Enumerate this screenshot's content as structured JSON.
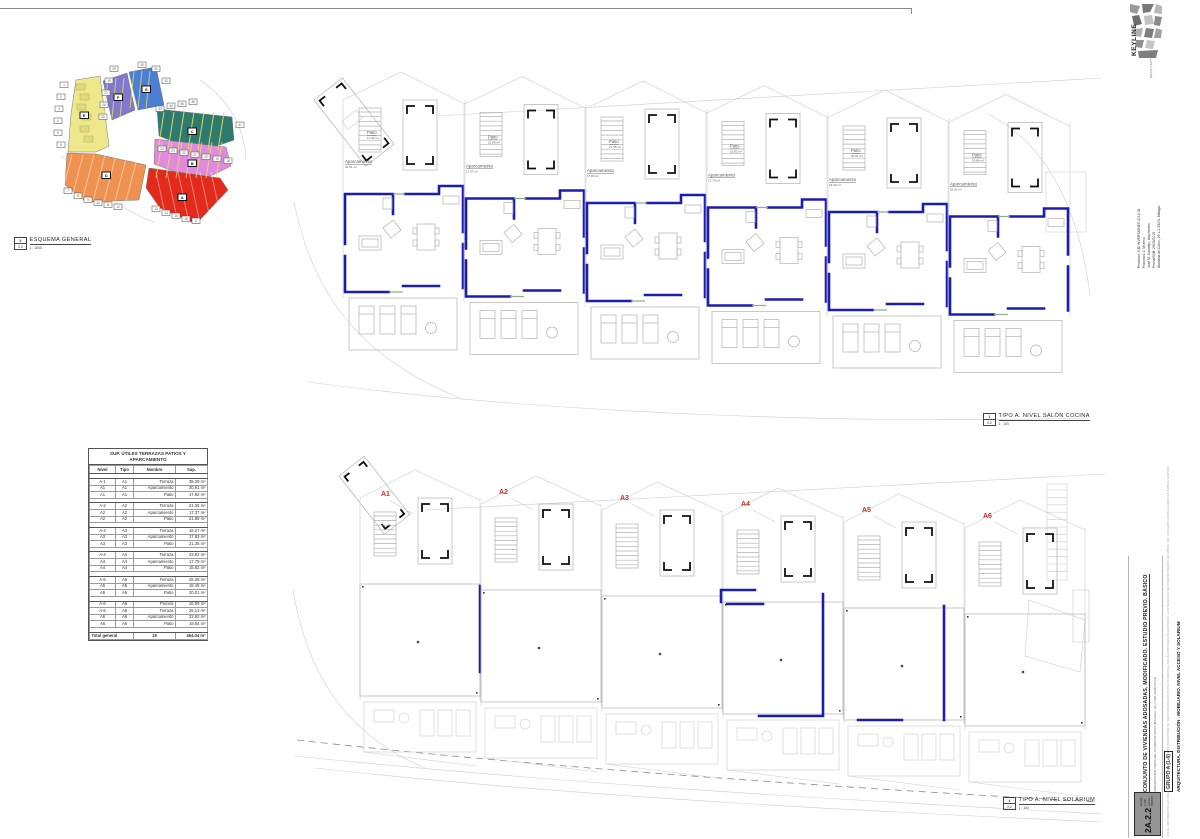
{
  "sheet": {
    "site_caption": {
      "ref_num": "3",
      "ref_sheet": "2.2",
      "title": "ESQUEMA GENERAL",
      "scale": "1 : 1000"
    },
    "plan_top_caption": {
      "ref_num": "1",
      "ref_sheet": "2.2",
      "title": "TIPO A. NIVEL SALÓN COCINA",
      "scale": "1 : 100"
    },
    "plan_bottom_caption": {
      "ref_num": "4",
      "ref_sheet": "2.2",
      "title": "TIPO A. NIVEL SOLARIUM",
      "scale": "1 : 100"
    }
  },
  "site_plan": {
    "zone_colors": {
      "yellow": "#efe88a",
      "purple": "#8078cc",
      "blue": "#4a7fd4",
      "teal": "#2f7a6e",
      "pink": "#e08ade",
      "orange": "#ef9251",
      "red": "#e32b1d"
    },
    "chips": [
      {
        "t": "1",
        "x": 10,
        "y": 22
      },
      {
        "t": "2",
        "x": 7,
        "y": 34
      },
      {
        "t": "3",
        "x": 5,
        "y": 46
      },
      {
        "t": "4",
        "x": 4,
        "y": 58
      },
      {
        "t": "5",
        "x": 4,
        "y": 70
      },
      {
        "t": "6",
        "x": 7,
        "y": 82
      },
      {
        "t": "29",
        "x": 60,
        "y": 6
      },
      {
        "t": "28",
        "x": 55,
        "y": 18
      },
      {
        "t": "27",
        "x": 52,
        "y": 30
      },
      {
        "t": "26",
        "x": 50,
        "y": 42
      },
      {
        "t": "25",
        "x": 49,
        "y": 54
      },
      {
        "t": "30",
        "x": 88,
        "y": 2
      },
      {
        "t": "31",
        "x": 102,
        "y": 6
      },
      {
        "t": "32",
        "x": 112,
        "y": 18
      },
      {
        "t": "33",
        "x": 106,
        "y": 46
      },
      {
        "t": "34",
        "x": 117,
        "y": 43
      },
      {
        "t": "35",
        "x": 128,
        "y": 41
      },
      {
        "t": "36",
        "x": 139,
        "y": 39
      },
      {
        "t": "37",
        "x": 186,
        "y": 62
      },
      {
        "t": "24",
        "x": 108,
        "y": 86
      },
      {
        "t": "23",
        "x": 119,
        "y": 88
      },
      {
        "t": "22",
        "x": 130,
        "y": 90
      },
      {
        "t": "21",
        "x": 141,
        "y": 92
      },
      {
        "t": "20",
        "x": 152,
        "y": 94
      },
      {
        "t": "19",
        "x": 163,
        "y": 96
      },
      {
        "t": "18",
        "x": 174,
        "y": 98
      },
      {
        "t": "7",
        "x": 14,
        "y": 128
      },
      {
        "t": "8",
        "x": 24,
        "y": 133
      },
      {
        "t": "9",
        "x": 34,
        "y": 137
      },
      {
        "t": "10",
        "x": 44,
        "y": 140
      },
      {
        "t": "11",
        "x": 54,
        "y": 142
      },
      {
        "t": "12",
        "x": 64,
        "y": 144
      },
      {
        "t": "13",
        "x": 102,
        "y": 146
      },
      {
        "t": "14",
        "x": 112,
        "y": 150
      },
      {
        "t": "15",
        "x": 122,
        "y": 153
      },
      {
        "t": "16",
        "x": 132,
        "y": 156
      },
      {
        "t": "17",
        "x": 142,
        "y": 158
      }
    ],
    "zone_boxes": [
      {
        "t": "E",
        "x": 30,
        "y": 52
      },
      {
        "t": "F",
        "x": 64,
        "y": 34
      },
      {
        "t": "G",
        "x": 92,
        "y": 26
      },
      {
        "t": "C",
        "x": 138,
        "y": 68
      },
      {
        "t": "B",
        "x": 138,
        "y": 100
      },
      {
        "t": "D",
        "x": 52,
        "y": 112
      },
      {
        "t": "A",
        "x": 128,
        "y": 134
      }
    ]
  },
  "area_table": {
    "title": "SUP. ÚTILES TERRAZAS PATIOS Y APARCAMIENTO",
    "columns": [
      "Nivel",
      "Tipo",
      "Nombre",
      "Sup."
    ],
    "groups": [
      {
        "rows": [
          [
            "A-1",
            "A1",
            "Terraza",
            "35.29 m²"
          ],
          [
            "A1",
            "A1",
            "Aparcamiento",
            "30.91 m²"
          ],
          [
            "A1",
            "A1",
            "Patio",
            "17.92 m²"
          ]
        ]
      },
      {
        "rows": [
          [
            "A-2",
            "A2",
            "Terraza",
            "21.35 m²"
          ],
          [
            "A2",
            "A2",
            "Aparcamiento",
            "17.37 m²"
          ],
          [
            "A2",
            "A2",
            "Patio",
            "21.88 m²"
          ]
        ]
      },
      {
        "rows": [
          [
            "A-3",
            "A3",
            "Terraza",
            "19.27 m²"
          ],
          [
            "A3",
            "A3",
            "Aparcamiento",
            "17.83 m²"
          ],
          [
            "A3",
            "A3",
            "Patio",
            "21.35 m²"
          ]
        ]
      },
      {
        "rows": [
          [
            "A-4",
            "A4",
            "Terraza",
            "23.92 m²"
          ],
          [
            "A4",
            "A4",
            "Aparcamiento",
            "17.79 m²"
          ],
          [
            "A4",
            "A4",
            "Patio",
            "15.82 m²"
          ]
        ]
      },
      {
        "rows": [
          [
            "A-5",
            "A5",
            "Terraza",
            "25.38 m²"
          ],
          [
            "A5",
            "A5",
            "Aparcamiento",
            "18.45 m²"
          ],
          [
            "A5",
            "A5",
            "Patio",
            "20.01 m²"
          ]
        ]
      },
      {
        "rows": [
          [
            "A-6",
            "A6",
            "Piscina",
            "16.59 m²"
          ],
          [
            "A-6",
            "A6",
            "Terraza",
            "26.13 m²"
          ],
          [
            "A6",
            "A6",
            "Aparcamiento",
            "32.92 m²"
          ],
          [
            "A6",
            "A6",
            "Patio",
            "19.84 m²"
          ]
        ]
      }
    ],
    "total_label": "Total general",
    "total_count": "19",
    "total_sup": "464.04 m²"
  },
  "plan_top": {
    "units": [
      {
        "id": "A1",
        "patio_label": "Patio",
        "patio_area": "17.92 m²",
        "aparc_label": "Aparcamiento",
        "aparc_area": "30.91 m²"
      },
      {
        "id": "A2",
        "patio_label": "Patio",
        "patio_area": "21.88 m²",
        "aparc_label": "Aparcamiento",
        "aparc_area": "17.37 m²"
      },
      {
        "id": "A3",
        "patio_label": "Patio",
        "patio_area": "21.35 m²",
        "aparc_label": "Aparcamiento",
        "aparc_area": "17.83 m²"
      },
      {
        "id": "A4",
        "patio_label": "Patio",
        "patio_area": "15.82 m²",
        "aparc_label": "Aparcamiento",
        "aparc_area": "17.79 m²"
      },
      {
        "id": "A5",
        "patio_label": "Patio",
        "patio_area": "20.01 m²",
        "aparc_label": "Aparcamiento",
        "aparc_area": "18.45 m²"
      },
      {
        "id": "A6",
        "patio_label": "Patio",
        "patio_area": "19.84 m²",
        "aparc_label": "Aparcamiento",
        "aparc_area": "32.92 m²"
      }
    ]
  },
  "plan_bottom": {
    "unit_labels": [
      "A1",
      "A2",
      "A3",
      "A4",
      "A5",
      "A6"
    ],
    "label_color": "#c23230"
  },
  "titleblock": {
    "logo_text": "KEYLINE",
    "logo_sub": "ARQUITECTOS",
    "promoter": [
      "Promotor: FJD INVERSIONES 2014 SL",
      "Francisco J. Moreno",
      "José M. Canalejo, Arquitectos"
    ],
    "contact": [
      "Fecha/SVB: 29/05/2015",
      "Alameda de Colón, 29 1-2 29001 Málaga"
    ],
    "project_title": "CONJUNTO DE VIVIENDAS ADOSADAS, MODIFICADO. ESTUDIO PREVIO. BÁSICO",
    "project_subtitle": "URBANIZACIÓN LOMAS DEL FLAMENCO, MIJAS (MÁLAGA). UE-2 URB. DOÑA PILAR",
    "group_label": "GRUPO A (1-6)",
    "content_label": "ARQUITECTURA. DISTRIBUCIÓN . MOBILIARIO. NIVEL ACCESO Y SOLARIUM",
    "sheet_code": "2A.2.2",
    "sheet_meta_1": "Escala 1:100",
    "sheet_meta_2": "Fecha 05/2015",
    "disclaimer": "ESTE DOCUMENTO ES PROPIEDAD DEL AUTOR. QUEDA PROHIBIDA SU REPRODUCCIÓN TOTAL O PARCIAL SIN AUTORIZACIÓN EXPRESA. LAS MEDIDAS SE COMPROBARÁN EN OBRA. NO UTILIZAR ESCALA GRÁFICA SOBRE COPIAS."
  }
}
